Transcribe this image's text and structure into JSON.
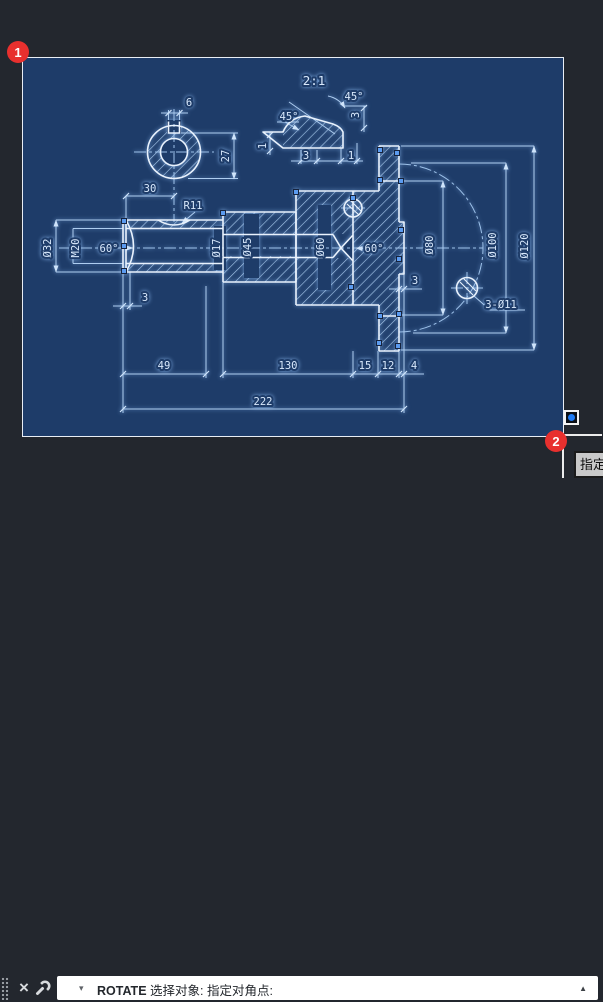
{
  "colors": {
    "app_bg": "#23272e",
    "selection_window_fill": "#1e3c69",
    "selection_window_border": "#e9eef5",
    "line_color": "#d9e9fc",
    "badge_red": "#e8302e",
    "grip_blue": "#5b9bf0",
    "pickbox_dot": "#1f7bf4"
  },
  "annotations": {
    "badges": [
      {
        "label": "1"
      },
      {
        "label": "2"
      }
    ]
  },
  "tooltip": {
    "text": "指定"
  },
  "command_bar": {
    "history_caret_icon": "▾",
    "close_icon": "×",
    "command": "ROTATE",
    "prompt": "选择对象: 指定对角点:",
    "expand_icon": "▲"
  },
  "drawing": {
    "labels": [
      {
        "t": "6",
        "x": 166,
        "y": 48
      },
      {
        "t": "27",
        "x": 206,
        "y": 98,
        "r": -90
      },
      {
        "t": "2:1",
        "x": 291,
        "y": 27,
        "s": 1
      },
      {
        "t": "45°",
        "x": 266,
        "y": 62
      },
      {
        "t": "45°",
        "x": 331,
        "y": 42
      },
      {
        "t": "3",
        "x": 336,
        "y": 57,
        "r": -90
      },
      {
        "t": "1",
        "x": 243,
        "y": 88,
        "r": -90
      },
      {
        "t": "3",
        "x": 283,
        "y": 101
      },
      {
        "t": "1",
        "x": 328,
        "y": 101
      },
      {
        "t": "30",
        "x": 127,
        "y": 134
      },
      {
        "t": "R11",
        "x": 170,
        "y": 151
      },
      {
        "t": "Ø32",
        "x": 28,
        "y": 190,
        "r": -90
      },
      {
        "t": "M20",
        "x": 56,
        "y": 190,
        "r": -90
      },
      {
        "t": "60°",
        "x": 86,
        "y": 194
      },
      {
        "t": "Ø17",
        "x": 197,
        "y": 190,
        "r": -90
      },
      {
        "t": "Ø45",
        "x": 228,
        "y": 189,
        "r": -90
      },
      {
        "t": "Ø60",
        "x": 301,
        "y": 189,
        "r": -90
      },
      {
        "t": "60°",
        "x": 351,
        "y": 194
      },
      {
        "t": "Ø80",
        "x": 410,
        "y": 187,
        "r": -90
      },
      {
        "t": "Ø100",
        "x": 473,
        "y": 187,
        "r": -90
      },
      {
        "t": "Ø120",
        "x": 505,
        "y": 188,
        "r": -90
      },
      {
        "t": "3",
        "x": 122,
        "y": 243
      },
      {
        "t": "3",
        "x": 392,
        "y": 226
      },
      {
        "t": "3-Ø11",
        "x": 478,
        "y": 250
      },
      {
        "t": "49",
        "x": 141,
        "y": 311
      },
      {
        "t": "130",
        "x": 265,
        "y": 311
      },
      {
        "t": "15",
        "x": 342,
        "y": 311
      },
      {
        "t": "12",
        "x": 365,
        "y": 311
      },
      {
        "t": "4",
        "x": 391,
        "y": 311
      },
      {
        "t": "222",
        "x": 240,
        "y": 347
      }
    ],
    "grips": [
      [
        101,
        163
      ],
      [
        101,
        188
      ],
      [
        101,
        213
      ],
      [
        200,
        155
      ],
      [
        273,
        134
      ],
      [
        330,
        140
      ],
      [
        357,
        92
      ],
      [
        374,
        95
      ],
      [
        357,
        122
      ],
      [
        378,
        123
      ],
      [
        378,
        172
      ],
      [
        376,
        201
      ],
      [
        328,
        229
      ],
      [
        376,
        256
      ],
      [
        356,
        285
      ],
      [
        375,
        288
      ],
      [
        357,
        258
      ]
    ]
  }
}
